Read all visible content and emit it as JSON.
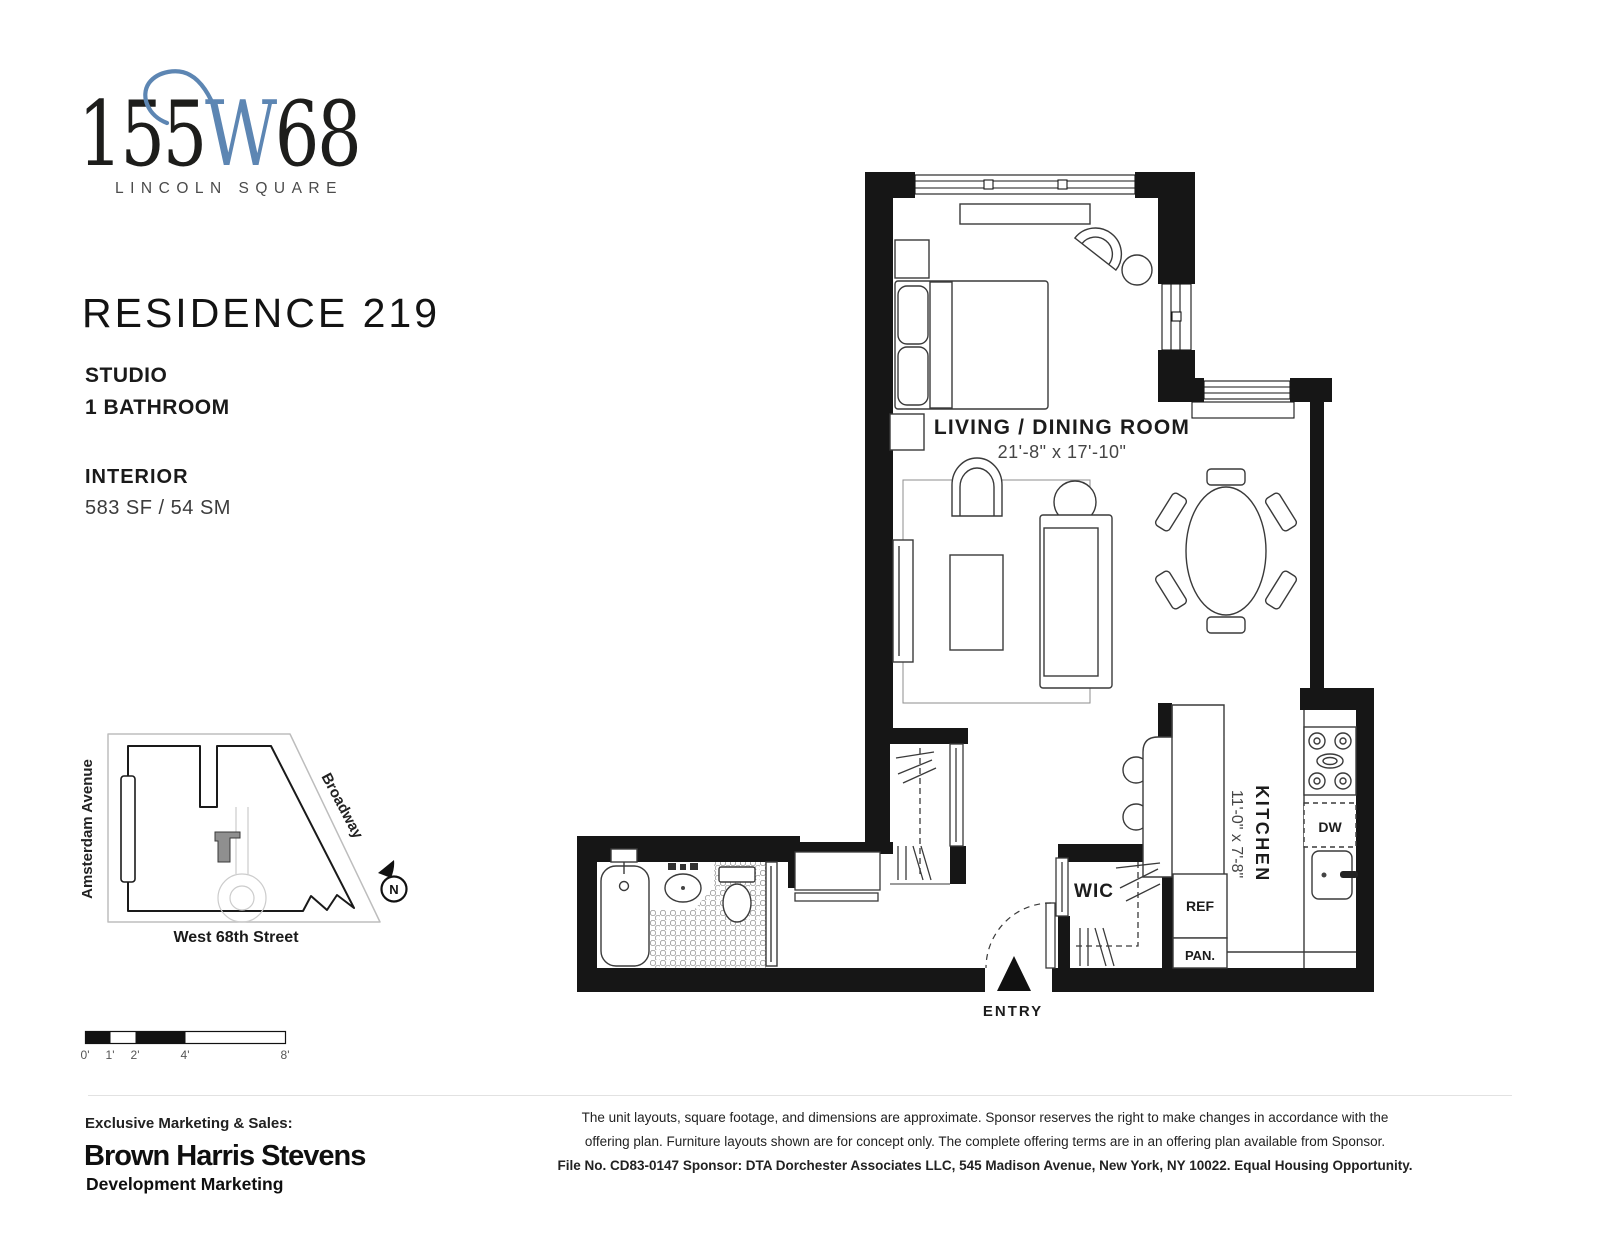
{
  "logo": {
    "num_prefix": "155",
    "num_w": "W",
    "num_suffix": "68",
    "subtitle": "LINCOLN SQUARE",
    "accent_blue": "#5d86b3"
  },
  "residence": {
    "title": "RESIDENCE 219",
    "unit_type": "STUDIO",
    "bathrooms": "1 BATHROOM",
    "interior_label": "INTERIOR",
    "area": "583 SF / 54 SM"
  },
  "floorplan": {
    "living_label": "LIVING / DINING ROOM",
    "living_dims": "21'-8\" x 17'-10\"",
    "kitchen_label": "KITCHEN",
    "kitchen_dims": "11'-0\" x 7'-8\"",
    "wic_label": "WIC",
    "ref_label": "REF",
    "pan_label": "PAN.",
    "dw_label": "DW",
    "entry_label": "ENTRY",
    "wall_color": "#161616"
  },
  "site_map": {
    "street_left": "Amsterdam Avenue",
    "street_right": "Broadway",
    "street_bottom": "West 68th Street",
    "north_label": "N"
  },
  "scale_bar": {
    "labels": [
      "0'",
      "1'",
      "2'",
      "4'",
      "8'"
    ]
  },
  "footer": {
    "marketing_label": "Exclusive Marketing & Sales:",
    "brokerage_name": "Brown Harris Stevens",
    "brokerage_division": "Development Marketing",
    "disclaimer_line1": "The unit layouts, square footage, and dimensions are approximate. Sponsor reserves the right to make changes in accordance with the",
    "disclaimer_line2": "offering plan. Furniture layouts shown are for concept only. The complete offering terms are in an offering plan available from Sponsor.",
    "disclaimer_line3": "File No. CD83-0147 Sponsor: DTA Dorchester Associates LLC, 545 Madison Avenue, New York, NY 10022. Equal Housing Opportunity."
  }
}
